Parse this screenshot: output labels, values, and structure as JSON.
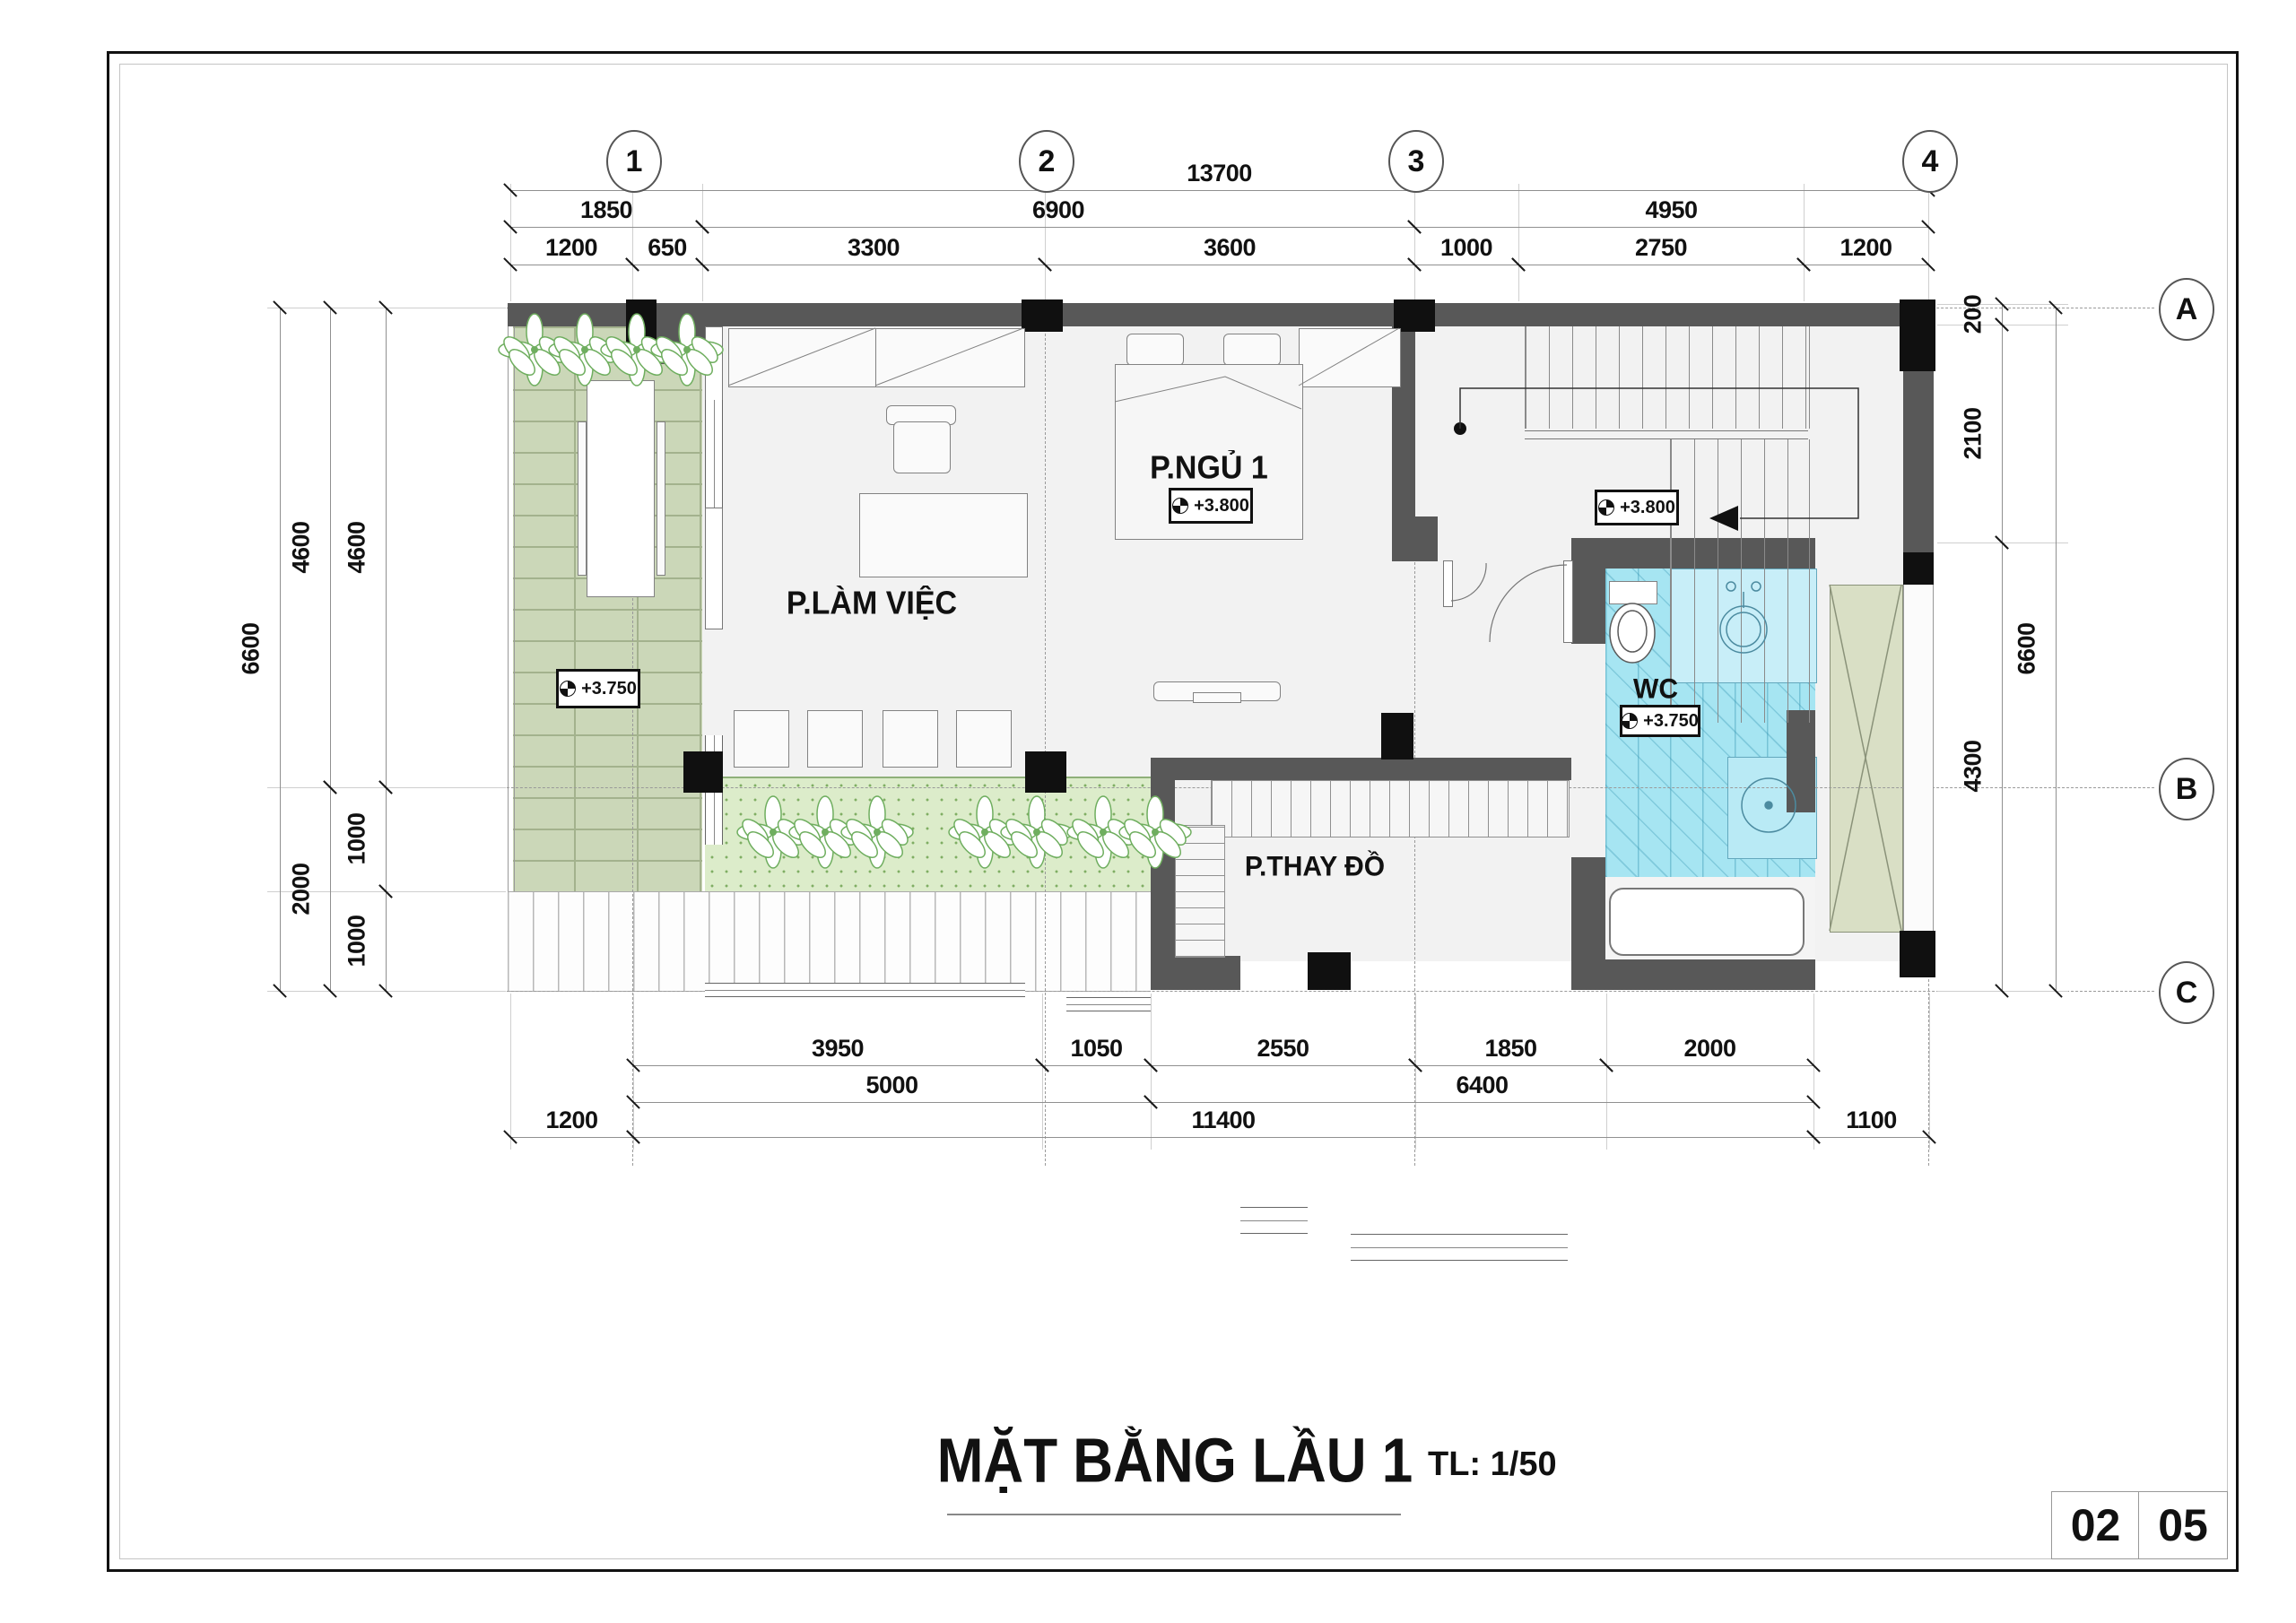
{
  "page": {
    "title": "MẶT BẰNG LẦU 1",
    "scale_label": "TL: 1/50"
  },
  "sheet_box": {
    "cells": [
      "02",
      "05"
    ]
  },
  "grid": {
    "columns": [
      "1",
      "2",
      "3",
      "4"
    ],
    "rows": [
      "A",
      "B",
      "C"
    ]
  },
  "rooms": {
    "bedroom": {
      "label": "P.NGỦ 1",
      "level": "+3.800"
    },
    "office": {
      "label": "P.LÀM VIỆC"
    },
    "dressing": {
      "label": "P.THAY ĐỒ"
    },
    "wc": {
      "label": "WC",
      "level": "+3.750"
    },
    "balcony_level": "+3.750",
    "stair_level": "+3.800"
  },
  "dimensions": {
    "top1": [
      "13700"
    ],
    "top2": [
      "1850",
      "6900",
      "4950"
    ],
    "top3": [
      "1200",
      "650",
      "3300",
      "3600",
      "1000",
      "2750",
      "1200"
    ],
    "bottom1": [
      "3950",
      "1050",
      "2550",
      "1850",
      "2000"
    ],
    "bottom2": [
      "5000",
      "6400"
    ],
    "bottom3": [
      "1200",
      "11400",
      "1100"
    ],
    "left_outer": [
      "6600"
    ],
    "left_mid": [
      "4600",
      "2000"
    ],
    "left_inner": [
      "4600",
      "1000",
      "1000"
    ],
    "right_inner": [
      "200",
      "2100",
      "4300"
    ],
    "right_outer": [
      "6600"
    ]
  },
  "colors": {
    "wall": "#585858",
    "column": "#101010",
    "floor": "#f2f2f2",
    "brick": "#cbd7b8",
    "planter": "#dcecca",
    "wc": "#a6e5f2",
    "void_shaft": "#d9dfc5"
  }
}
